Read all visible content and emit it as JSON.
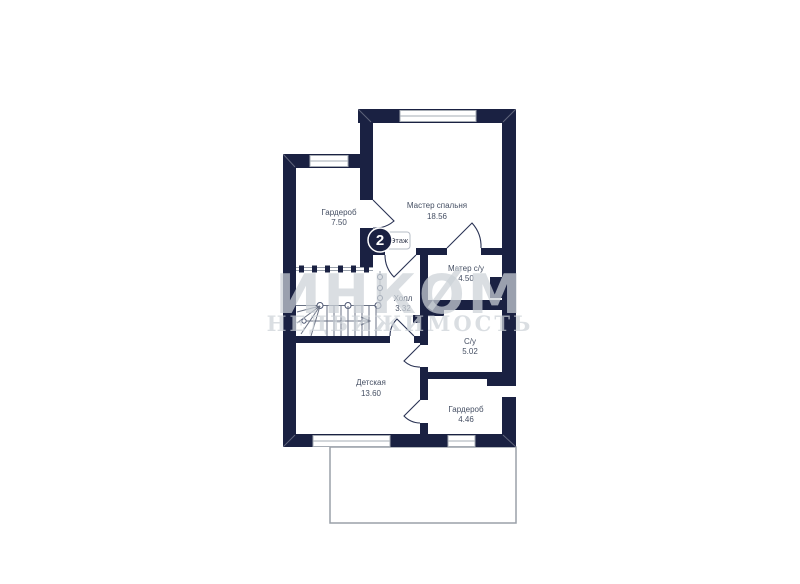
{
  "floor_badge": {
    "number": "2",
    "label": "Этаж"
  },
  "rooms": [
    {
      "name": "Гардероб",
      "area": "7.50"
    },
    {
      "name": "Мастер спальня",
      "area": "18.56"
    },
    {
      "name": "Матер с/у",
      "area": "4.50"
    },
    {
      "name": "Холл",
      "area": "3.32"
    },
    {
      "name": "С/у",
      "area": "5.02"
    },
    {
      "name": "Детская",
      "area": "13.60"
    },
    {
      "name": "Гардероб",
      "area": "4.46"
    }
  ],
  "watermark": {
    "brand": "ИНКОМ",
    "subtitle": "НЕДВИЖИМОСТЬ"
  },
  "colors": {
    "wall": "#1a2142",
    "label": "#454f63",
    "watermark": "#ccd2d8"
  }
}
